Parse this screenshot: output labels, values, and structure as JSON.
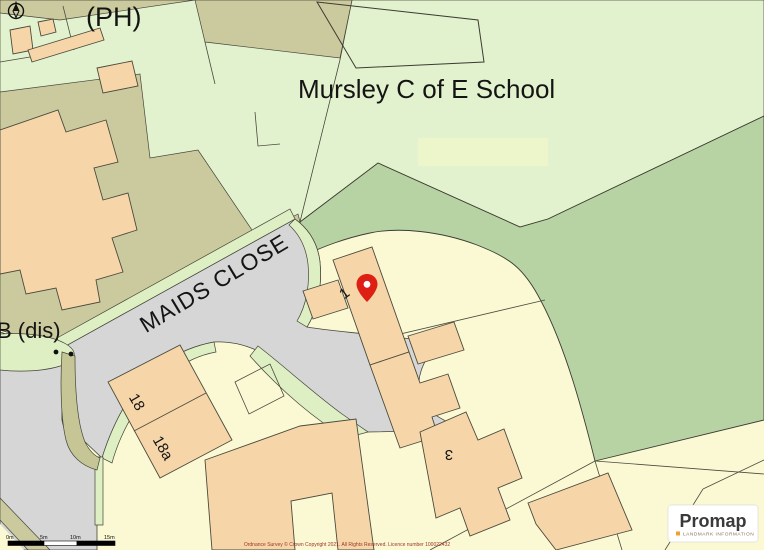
{
  "map": {
    "labels": {
      "pub": "(PH)",
      "school": "Mursley C of E School",
      "street": "MAIDS CLOSE",
      "telephone_disused": "B (dis)",
      "plot_1": "1",
      "plot_18": "18",
      "plot_18a": "18a",
      "plot_3": "3"
    },
    "scale_bar": {
      "ticks": [
        "0m",
        "5m",
        "10m",
        "15m"
      ]
    },
    "attribution": "Ordnance Survey © Crown Copyright 2021. All Rights Reserved. Licence number 100022432",
    "logo": {
      "brand": "Promap",
      "tagline": "LANDMARK INFORMATION"
    },
    "icons": {
      "marker": "location-pin-icon",
      "compass": "north-arrow-icon"
    },
    "colors": {
      "parcel_yellow": "#fbf9d3",
      "building_peach": "#f6d6a8",
      "grass_light_green": "#e3f2ce",
      "woodland_green": "#b8d3a3",
      "scrub_olive": "#cbca9e",
      "road_gray": "#d6d6d6",
      "verge_green": "#ddefc3",
      "pin_red": "#dd1f14",
      "logo_orange": "#f0a030",
      "attribution_red": "#9c3324"
    }
  }
}
